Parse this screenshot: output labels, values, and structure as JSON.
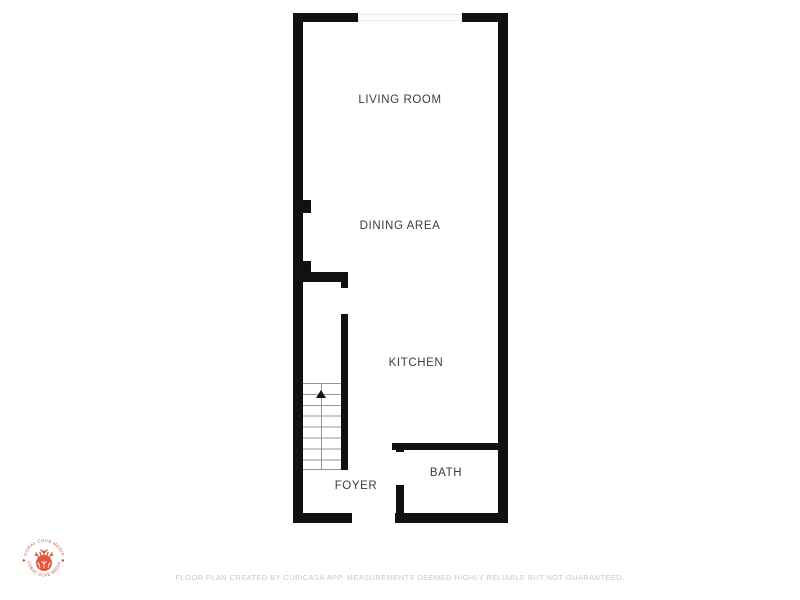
{
  "rooms": {
    "living_room": {
      "label": "LIVING ROOM"
    },
    "dining_area": {
      "label": "DINING AREA"
    },
    "kitchen": {
      "label": "KITCHEN"
    },
    "foyer": {
      "label": "FOYER"
    },
    "bath": {
      "label": "BATH"
    }
  },
  "logo": {
    "brand_top": "CORAL COVE MEDIA",
    "brand_bottom": "CORAL COVE MEDIA",
    "separator_left": "◆",
    "separator_right": "◆"
  },
  "footer": {
    "text": "FLOOR PLAN CREATED BY CUBICASA APP. MEASUREMENTS DEEMED HIGHLY RELIABLE BUT NOT GUARANTEED."
  },
  "colors": {
    "wall": "#111111",
    "room_label": "#3c3c3c",
    "stair_lines": "#969696",
    "coral_logo": "#e2563f",
    "logo_text": "#bf5a49",
    "footer_text": "#c8c8c8"
  }
}
